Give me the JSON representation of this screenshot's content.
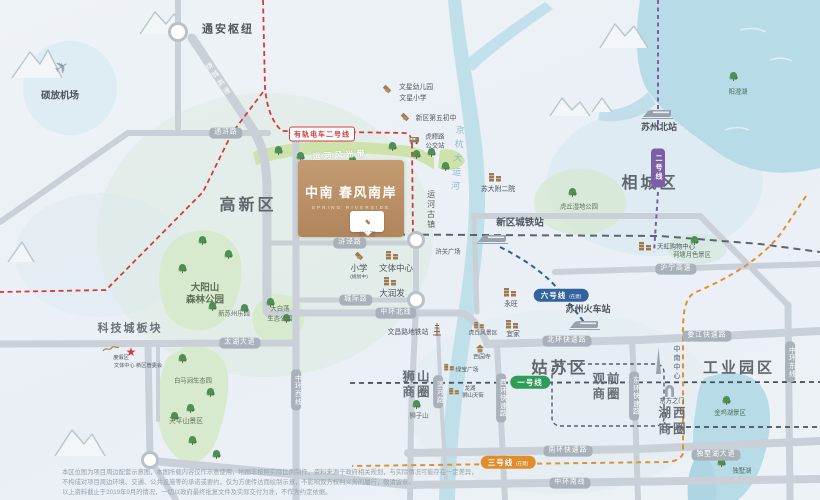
{
  "project": {
    "name": "中南 春风南岸",
    "subtitle": "SPRING RIVERSIDE",
    "kindergarten": "幼儿园"
  },
  "icons": {
    "sales_star": "★",
    "plane": "✈"
  },
  "districts": {
    "gaoxin": "高新区",
    "xiangcheng": "相城区",
    "gusu": "姑苏区",
    "gongyeyuanqu": "工业园区",
    "kejicheng": "科技城板块",
    "shishan1": "狮山",
    "shishan2": "商圈",
    "guanqian1": "观前",
    "guanqian2": "商圈",
    "huxi1": "湖西",
    "huxi2": "商圈"
  },
  "stations": {
    "tongan": "通安枢纽",
    "xinqu_chengtie": "新区城铁站",
    "suzhou_bei": "苏州北站",
    "suzhou_huochezhan": "苏州火车站",
    "wenchanglu": "文昌路地铁站",
    "huliu1": "虎疁路",
    "huliu2": "公交站"
  },
  "transit": {
    "tram2": "有轨电车二号线",
    "line1": "一号线",
    "line2": "二号线",
    "line3": "三号线",
    "line3_note": "(在建)",
    "line6": "六号线",
    "line6_note": "(在建)"
  },
  "roads": {
    "tonghu": "通浒路",
    "hujing": "浒泾路",
    "chengji": "城际路",
    "raocheng": "绕城高速",
    "zhonghuan_bei": "中环北线",
    "zhonghuan_xi": "中环西线",
    "zhonghuan_nan": "中环南线",
    "zhonghuan_dong": "中环东线",
    "taihu": "太湖大道",
    "beihuan": "北环快速路",
    "loujiang": "娄江快速路",
    "nanhuan": "南环快速路",
    "dushuhu_dadao": "独墅湖大道",
    "xihuan": "西环快速路",
    "donghuan": "东环快速路",
    "binhe": "滨河路",
    "huning": "沪宁高速"
  },
  "water": {
    "canal": "京杭大运河",
    "canal_belt": "运河风光带",
    "gu_town": "运河古镇",
    "yangchenghu": "阳澄湖",
    "jinjihu": "金鸡湖景区",
    "dushuhu": "独墅湖"
  },
  "parks": {
    "dayangshan1": "大阳山",
    "dayangshan2": "森林公园",
    "dabaidang1": "大白荡",
    "dabaidang2": "生态公园",
    "baimajian": "白马涧生态园",
    "tianpingshan": "天平山景区",
    "huqiu_shidi": "虎丘湿地公园",
    "hetang": "荷塘月色景区",
    "shizishan": "狮子山",
    "xin_suzhou_leyuan": "新苏州乐园"
  },
  "pois": {
    "airport": "硕放机场",
    "wenxing_youeryuan": "文星幼儿园",
    "wenxing_xiaoxue": "文星小学",
    "diwu_chuzhong": "新区第五初中",
    "suda_fuer": "苏大附二院",
    "xiaoxue": "小学",
    "xiaoxue_note": "(规划中)",
    "wenti_zhongxin": "文体中心",
    "darunfa": "大润发",
    "yongwang": "永旺",
    "yijia": "宜家",
    "tianhong": "天虹购物中心",
    "huguan_guangchang": "浒关广场",
    "lvbao_guangchang": "绿宝广场",
    "longhu1": "龙湖",
    "longhu2": "狮山天街",
    "huqiu": "虎丘风景区",
    "xiyuansi": "西园寺",
    "zhongnan_zhongxin": "中南中心",
    "dongfangzhimen": "东方之门",
    "dujiaqu": "度假区",
    "wenti_guanwei": "文体中心 新区管委会"
  },
  "disclaimer": {
    "line1": "本区位图为项目周边配套示意图，本图所载内容仅作示意使用，地图非按照实际比例制作，资料来源于政府相关规划，与实际情况可能存在一定差异，",
    "line2": "不构成对项目周边环境、交通、公共设施等的承诺或要约，仅为方便传达而绘制示意，不影响双方权利义务的履行，敬请留意。",
    "line3": "以上资料截止于2019年9月的情况，一切以政府最终批复文件及实际交付为准，不作为约定依据。"
  }
}
